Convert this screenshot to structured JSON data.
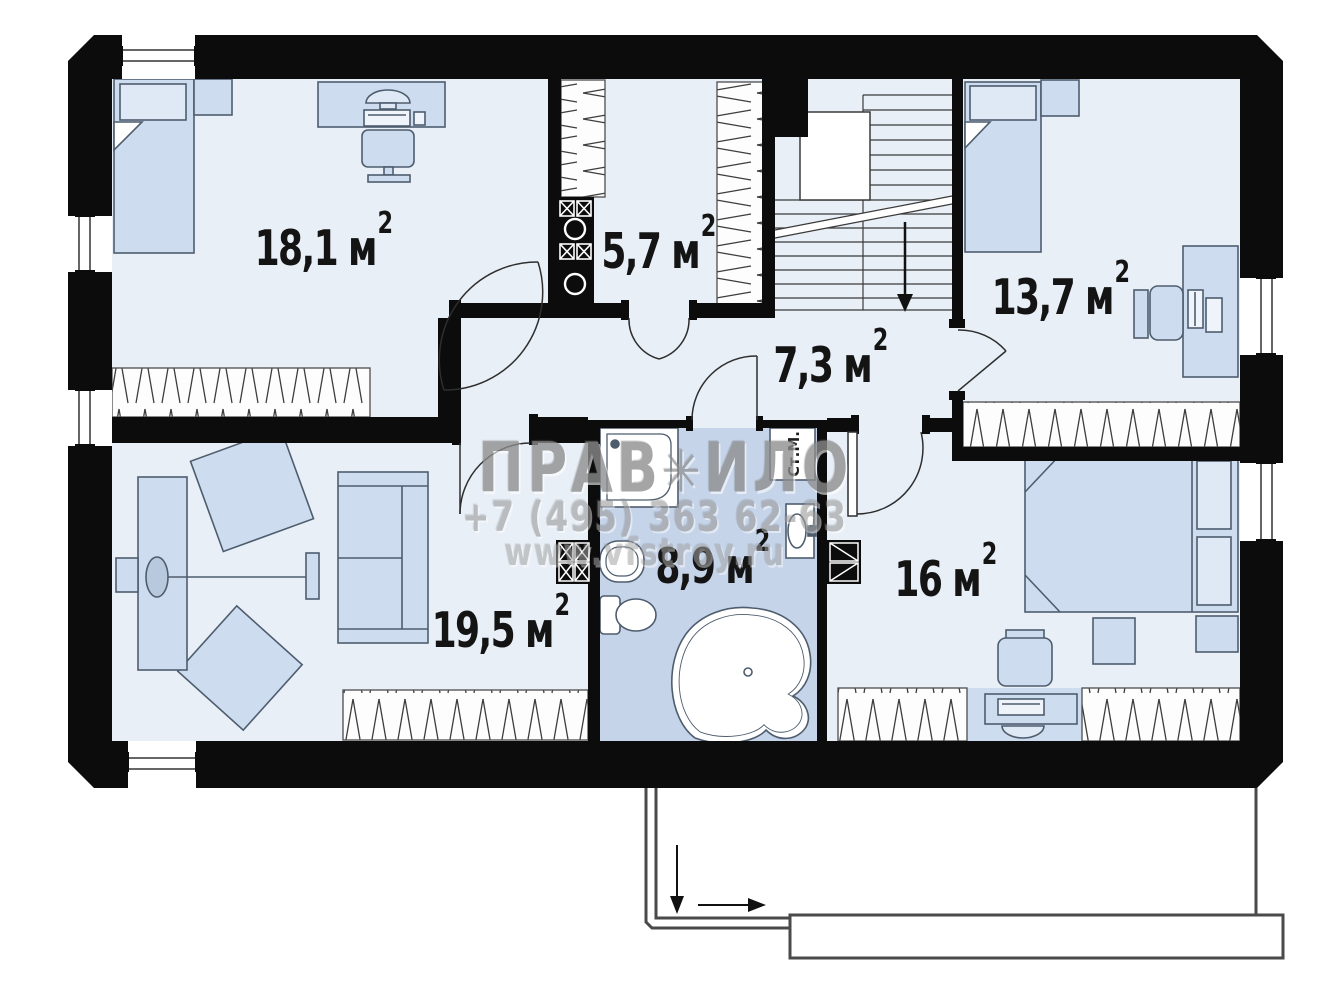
{
  "plan": {
    "type": "floor-plan",
    "floor_outline_present": true,
    "units_note": "areas in square meters"
  },
  "rooms": [
    {
      "id": "bedroom-top-left",
      "area": "18,1",
      "unit": "м",
      "sup": "2"
    },
    {
      "id": "wardrobe",
      "area": "5,7",
      "unit": "м",
      "sup": "2"
    },
    {
      "id": "hallway",
      "area": "7,3",
      "unit": "м",
      "sup": "2"
    },
    {
      "id": "bedroom-top-right",
      "area": "13,7",
      "unit": "м",
      "sup": "2"
    },
    {
      "id": "living-room",
      "area": "19,5",
      "unit": "м",
      "sup": "2"
    },
    {
      "id": "bathroom",
      "area": "8,9",
      "unit": "м",
      "sup": "2"
    },
    {
      "id": "bedroom-bottom-right",
      "area": "16",
      "unit": "м",
      "sup": "2"
    }
  ],
  "labels": {
    "washing_machine": "Ст.М."
  },
  "watermark": {
    "brand_left": "ПРАВ",
    "ornament": "✳",
    "brand_right": "ИЛО",
    "phone": "+7 (495) 363 62-63",
    "site": "www.vfstroy.ru"
  },
  "icons": [
    "staircase-down-arrow",
    "entrance-down-arrow",
    "entrance-right-arrow",
    "bed-icon",
    "desk-icon",
    "sofa-icon",
    "armchair-square-icon",
    "shower-icon",
    "toilet-icon",
    "sink-icon",
    "corner-bathtub-icon",
    "washing-machine-icon",
    "chimney-icon",
    "window-icon"
  ],
  "colors": {
    "wall": "#0c0c0c",
    "floor": "#e9eff7",
    "bathroom_floor": "#c5d4e9",
    "furniture_fill": "#cddcee",
    "furniture_stroke": "#4e5d6e",
    "watermark_gray": "#8d8d8d"
  }
}
